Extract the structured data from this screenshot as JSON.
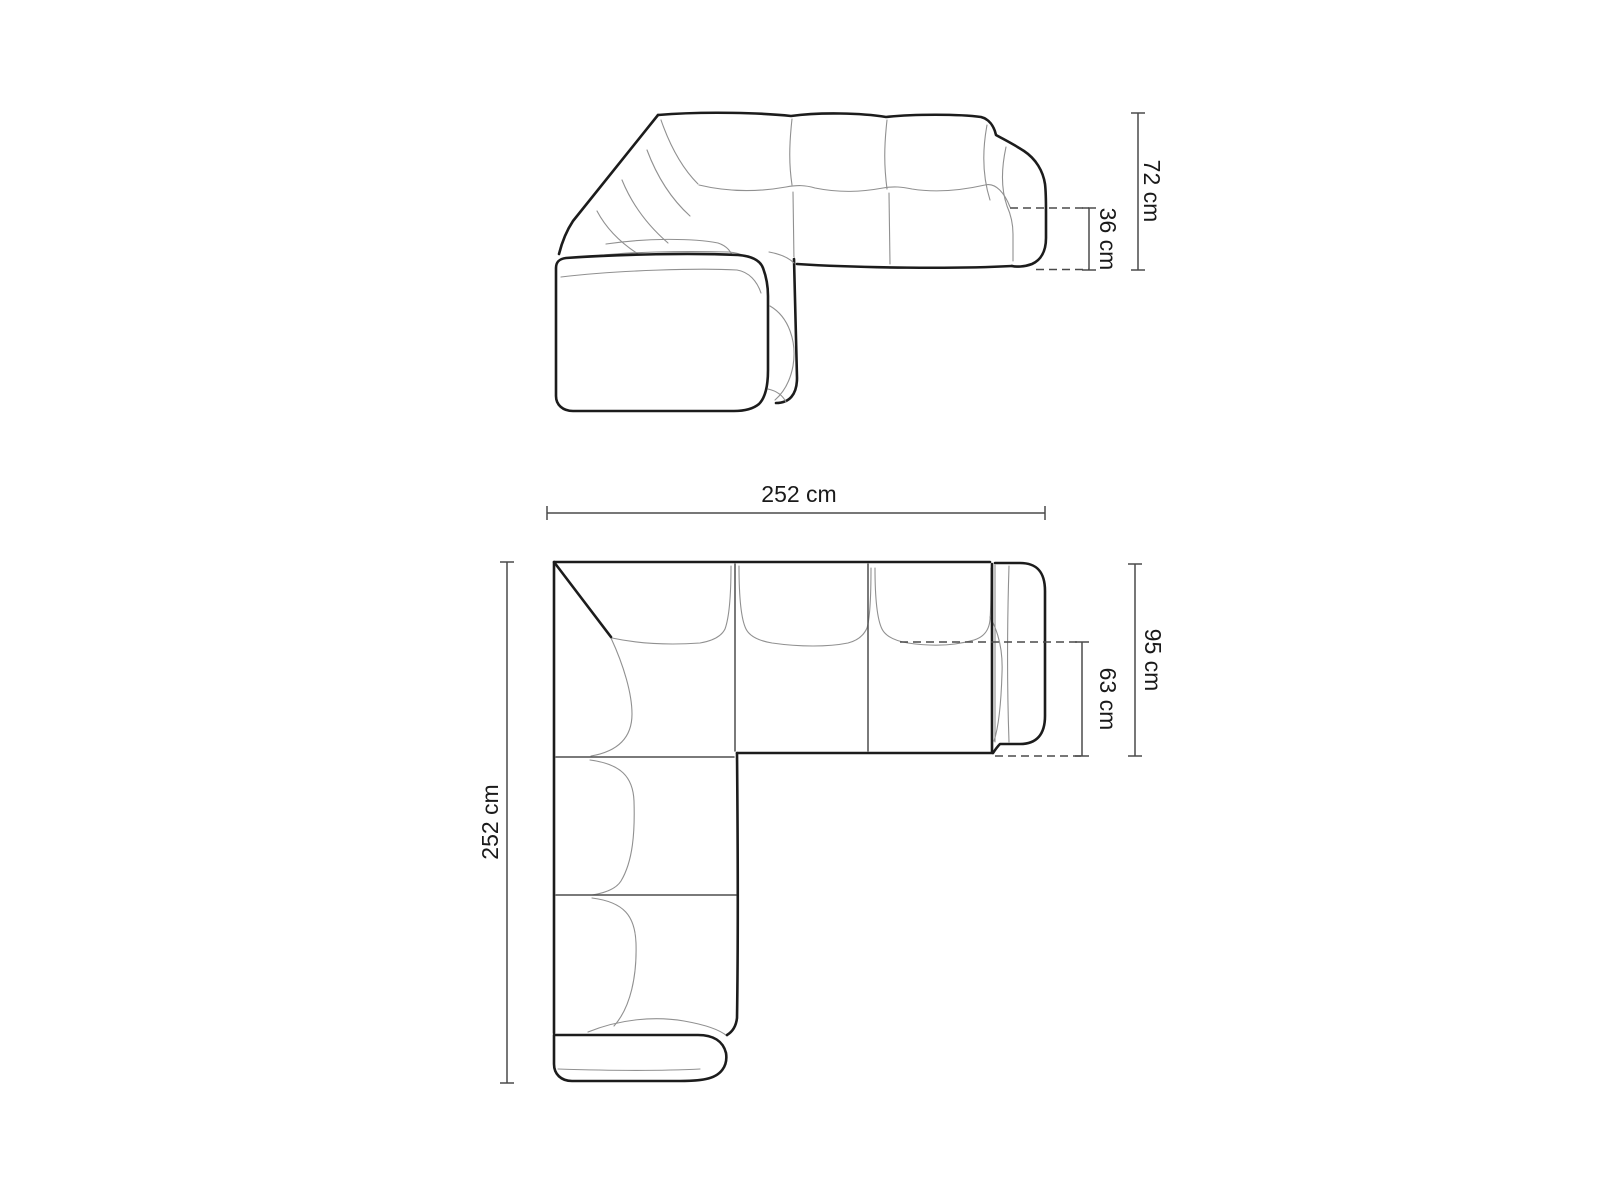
{
  "colors": {
    "background": "#ffffff",
    "outline_bold": "#1c1c1c",
    "separator": "#4f4f4f",
    "seam": "#909090",
    "dimension": "#4a4a4a",
    "label": "#1a1a1a"
  },
  "front_view": {
    "dimensions": {
      "total_height": "72 cm",
      "seat_height": "36 cm"
    }
  },
  "top_view": {
    "dimensions": {
      "total_width": "252 cm",
      "total_depth": "252 cm",
      "side_depth": "95 cm",
      "seat_depth": "63 cm"
    }
  }
}
